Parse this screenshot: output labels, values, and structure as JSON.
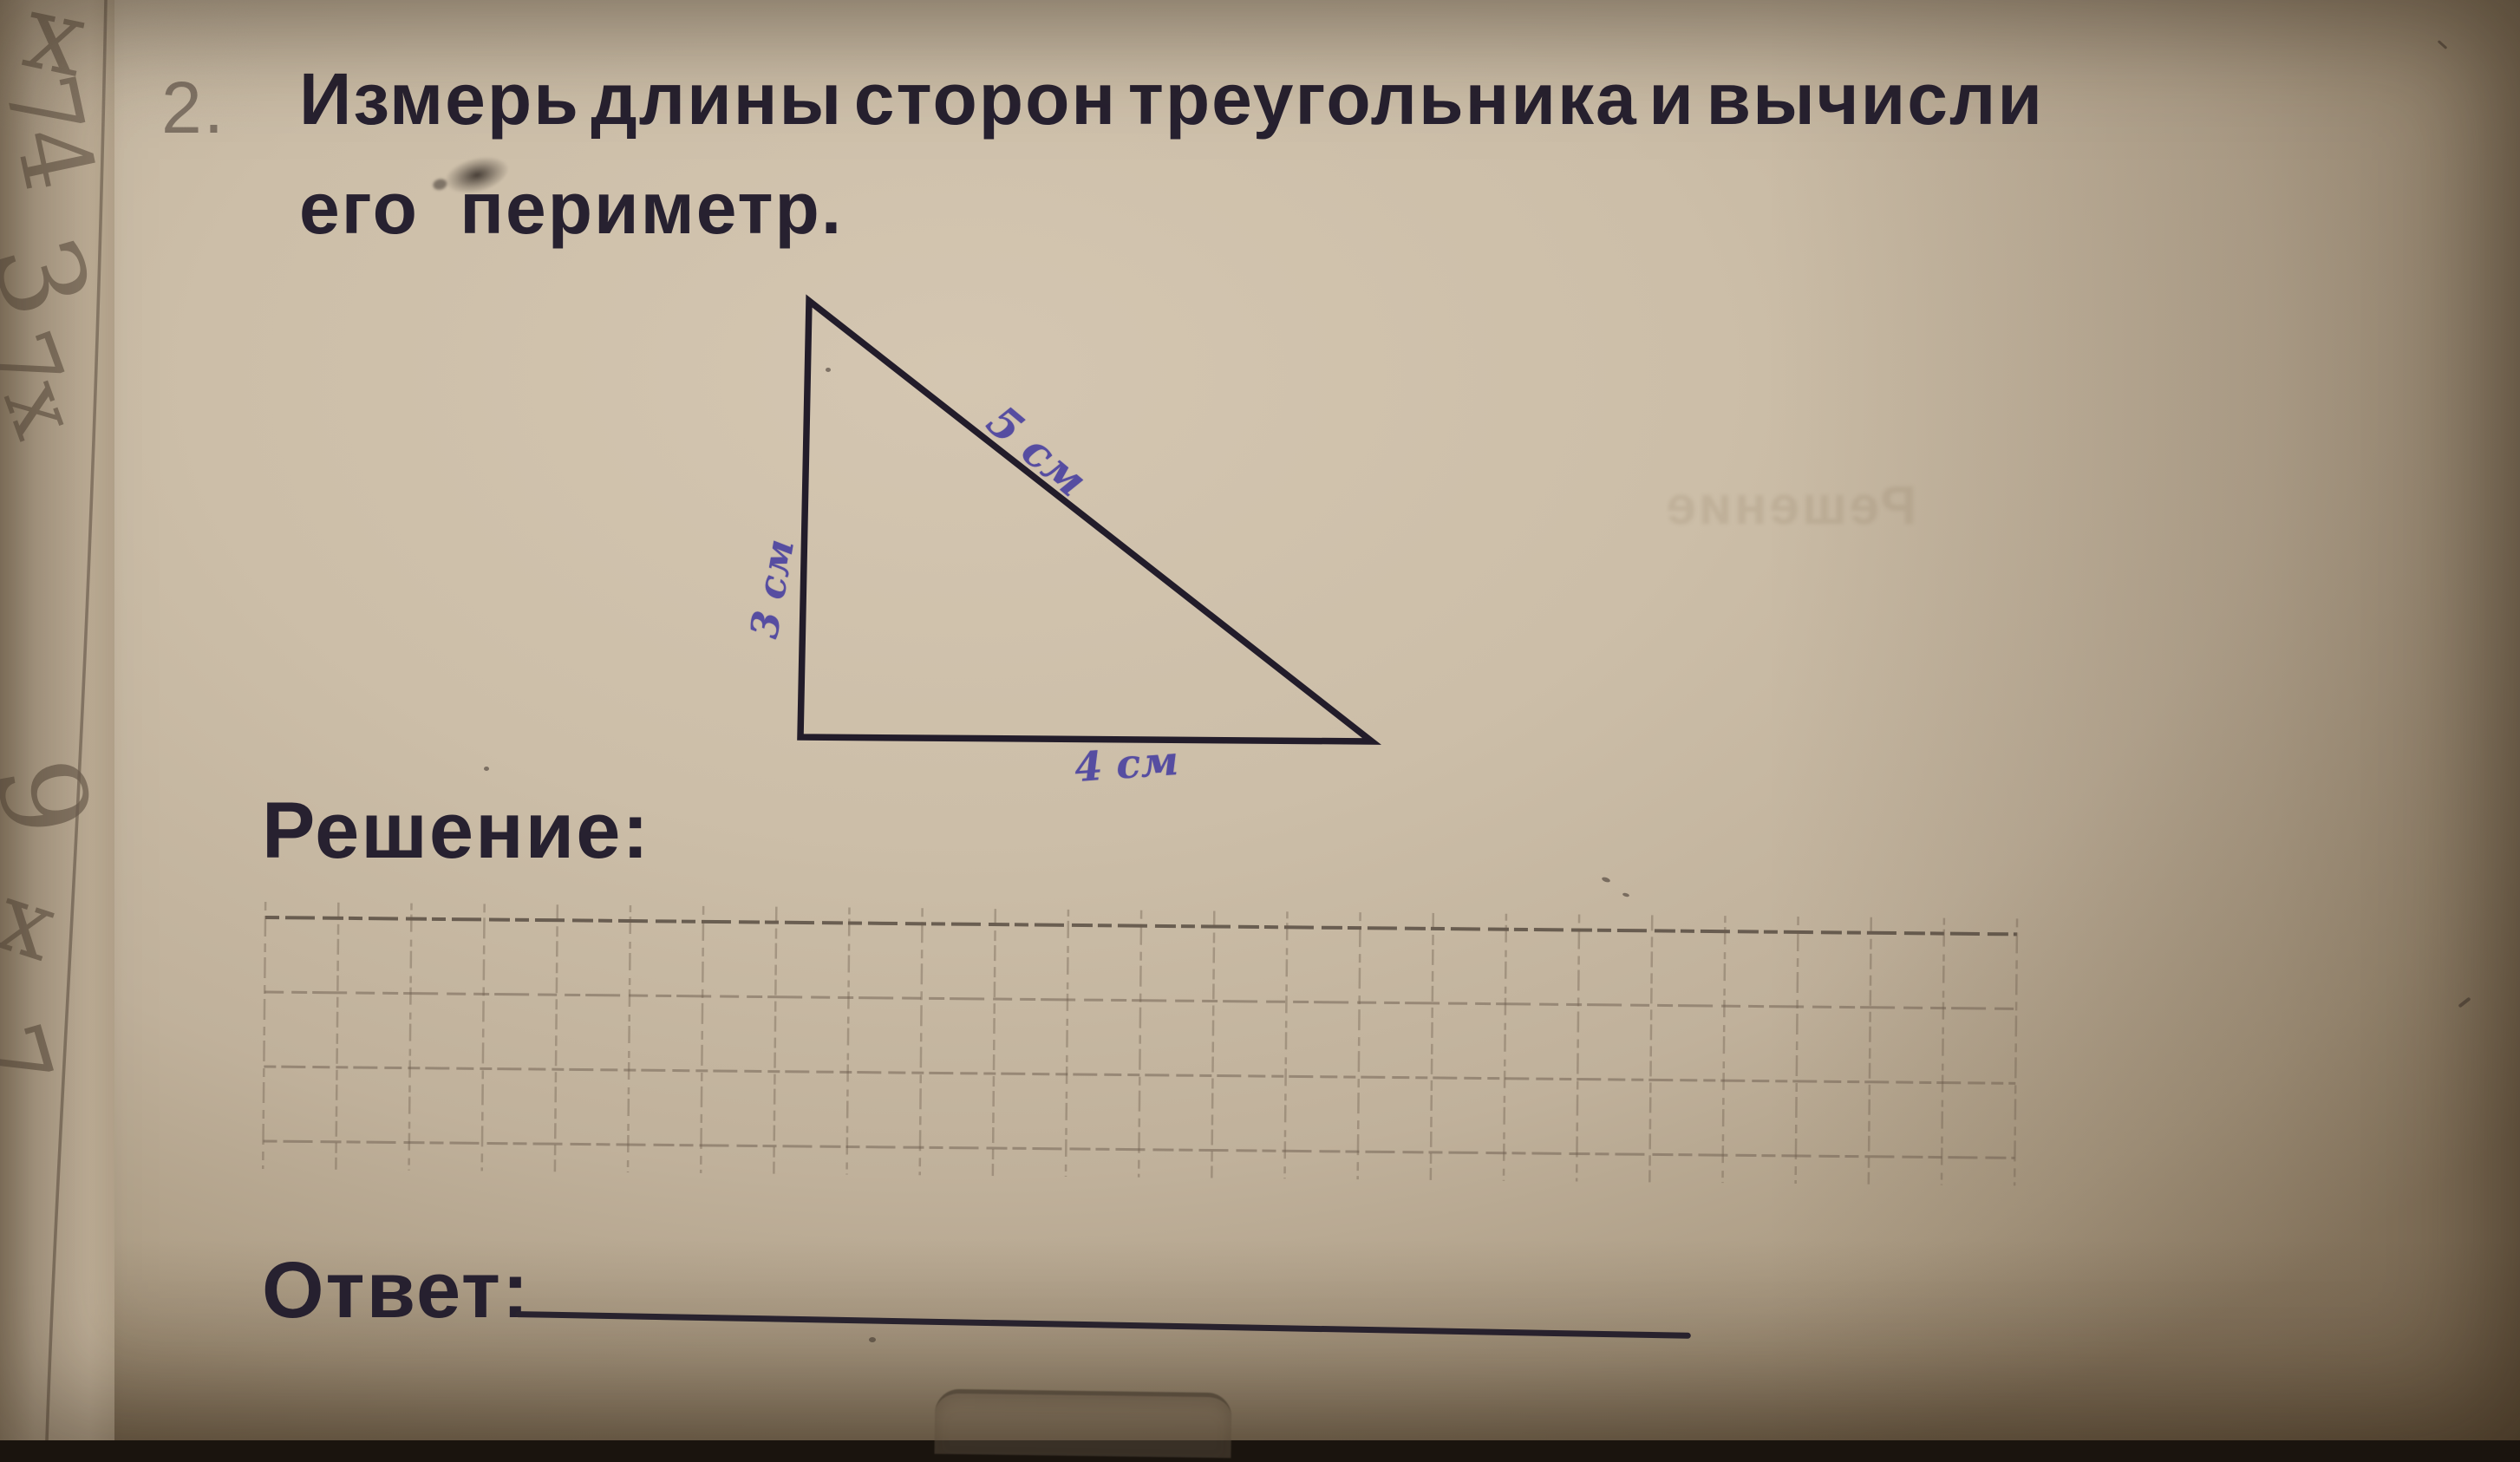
{
  "page": {
    "task_number": "2.",
    "title_line1": "Измерь длины сторон треугольника и вычисли",
    "title_line2": "его периметр.",
    "solution_label": "Решение:",
    "answer_label": "Ответ:",
    "bleed_through_text": "Решение"
  },
  "figure": {
    "type": "triangle",
    "vertices": [
      [
        933,
        347
      ],
      [
        923,
        850
      ],
      [
        1582,
        855
      ]
    ],
    "side_labels": [
      {
        "side": "hypotenuse",
        "text": "5 см"
      },
      {
        "side": "left-vertical",
        "text": "3 см"
      },
      {
        "side": "base",
        "text": "4 см"
      }
    ]
  },
  "solution_grid": {
    "rows": 3,
    "columns": 24
  },
  "margin_scribbles": [
    {
      "text": "x"
    },
    {
      "text": "74"
    },
    {
      "text": "3"
    },
    {
      "text": "7x"
    },
    {
      "text": "9"
    },
    {
      "text": "x"
    },
    {
      "text": "7"
    }
  ],
  "colors": {
    "paper": "#ccbea8",
    "print_ink": "#272130",
    "pen_ink": "#564da1",
    "pencil": "#7a6b5a",
    "grid_line": "#6b5c4d"
  }
}
